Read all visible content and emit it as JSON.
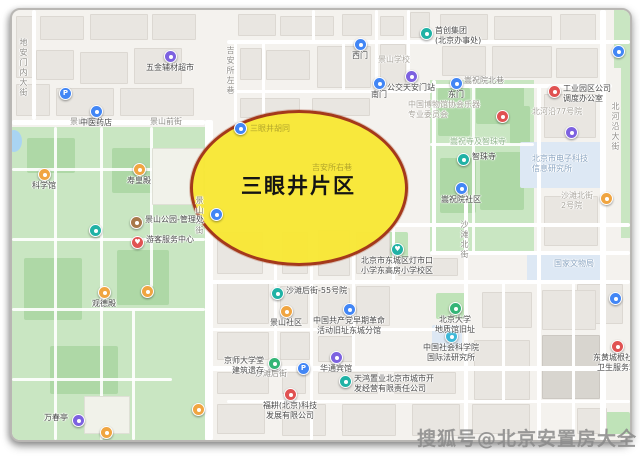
{
  "highlight": {
    "label": "三眼井片区",
    "fill": "#f8e734",
    "border": "#a4391b"
  },
  "watermark": {
    "text": "搜狐号@北京安置房大全"
  },
  "map": {
    "poi_colors": {
      "blue": "#4286f5",
      "purple": "#7d62e0",
      "teal": "#20b2a5",
      "red": "#e05252",
      "orange": "#f0a541",
      "brown": "#a8784a",
      "green": "#35b576",
      "cyan": "#3cb8d8"
    },
    "in_ellipse_labels": [
      {
        "text": "三眼井胡同",
        "x": 238,
        "y": 113
      },
      {
        "text": "吉安所右巷",
        "x": 300,
        "y": 152
      }
    ],
    "labels": [
      {
        "lines": [
          "地安门内大街"
        ],
        "x": 6,
        "y": 28,
        "style": "roadv"
      },
      {
        "lines": [
          "景山后街"
        ],
        "x": 58,
        "y": 107,
        "style": "road"
      },
      {
        "lines": [
          "景山前街"
        ],
        "x": 138,
        "y": 107,
        "style": "road"
      },
      {
        "lines": [
          "景山东街"
        ],
        "x": 182,
        "y": 186,
        "style": "roadv"
      },
      {
        "lines": [
          "吉安所左巷"
        ],
        "x": 213,
        "y": 36,
        "style": "roadv"
      },
      {
        "lines": [
          "嵩祝院北巷"
        ],
        "x": 452,
        "y": 66,
        "style": "road"
      },
      {
        "lines": [
          "沙滩北街"
        ],
        "x": 447,
        "y": 210,
        "style": "roadv"
      },
      {
        "lines": [
          "沙滩后街"
        ],
        "x": 243,
        "y": 359,
        "style": "road"
      },
      {
        "lines": [
          "北河沿大街"
        ],
        "x": 598,
        "y": 92,
        "style": "roadv"
      },
      {
        "lines": [
          "景山学校"
        ],
        "x": 366,
        "y": 45,
        "style": "area"
      },
      {
        "lines": [
          "北河沿77号院"
        ],
        "x": 520,
        "y": 97,
        "style": "area"
      },
      {
        "lines": [
          "北京市电子科技",
          "信息研究所"
        ],
        "x": 520,
        "y": 144,
        "style": "blue"
      },
      {
        "lines": [
          "国家文物局"
        ],
        "x": 542,
        "y": 249,
        "style": "blue"
      },
      {
        "lines": [
          "沙滩北街",
          "2号院"
        ],
        "x": 549,
        "y": 181,
        "style": "area"
      },
      {
        "lines": [
          "中国博物馆协会乐器",
          "专业委员会"
        ],
        "x": 396,
        "y": 90,
        "style": "area"
      },
      {
        "lines": [
          "嵩祝寺及智珠寺"
        ],
        "x": 438,
        "y": 127,
        "style": "faintgreen"
      }
    ],
    "pois": [
      {
        "x": 152,
        "y": 40,
        "c": "purple",
        "label": [
          "五金辅材超市"
        ],
        "pos": "below"
      },
      {
        "x": 47,
        "y": 77,
        "c": "blue",
        "g": "P"
      },
      {
        "x": 78,
        "y": 95,
        "c": "blue",
        "label": [
          "中医药店"
        ],
        "pos": "below"
      },
      {
        "x": 342,
        "y": 28,
        "c": "blue",
        "label": [
          "西门"
        ],
        "pos": "below"
      },
      {
        "x": 408,
        "y": 17,
        "c": "teal",
        "label": [
          "首创集团",
          "(北京办事处)"
        ],
        "pos": "right"
      },
      {
        "x": 393,
        "y": 60,
        "c": "purple",
        "label": [
          "公交天安门站"
        ],
        "pos": "below"
      },
      {
        "x": 361,
        "y": 67,
        "c": "blue",
        "label": [
          "南门"
        ],
        "pos": "below"
      },
      {
        "x": 438,
        "y": 67,
        "c": "blue",
        "label": [
          "东门"
        ],
        "pos": "below"
      },
      {
        "x": 536,
        "y": 75,
        "c": "red",
        "label": [
          "工业园区公司",
          "调度办公室"
        ],
        "pos": "right"
      },
      {
        "x": 600,
        "y": 35,
        "c": "blue"
      },
      {
        "x": 445,
        "y": 143,
        "c": "teal",
        "label": [
          "智珠寺"
        ],
        "pos": "right"
      },
      {
        "x": 484,
        "y": 100,
        "c": "red"
      },
      {
        "x": 443,
        "y": 172,
        "c": "blue",
        "label": [
          "嵩祝院社区"
        ],
        "pos": "below"
      },
      {
        "x": 553,
        "y": 116,
        "c": "purple"
      },
      {
        "x": 588,
        "y": 182,
        "c": "orange"
      },
      {
        "x": 259,
        "y": 277,
        "c": "teal",
        "label": [
          "沙滩后街-55号院"
        ],
        "pos": "right"
      },
      {
        "x": 268,
        "y": 295,
        "c": "orange",
        "label": [
          "景山社区"
        ],
        "pos": "below"
      },
      {
        "x": 331,
        "y": 293,
        "c": "blue",
        "label": [
          "中国共产党早期革命",
          "活动旧址东城分馆"
        ],
        "pos": "below"
      },
      {
        "x": 256,
        "y": 347,
        "c": "green",
        "label": [
          "京师大学堂",
          "建筑遗存"
        ],
        "pos": "left"
      },
      {
        "x": 285,
        "y": 352,
        "c": "blue",
        "g": "P"
      },
      {
        "x": 318,
        "y": 341,
        "c": "purple",
        "label": [
          "华通宾馆"
        ],
        "pos": "below"
      },
      {
        "x": 379,
        "y": 233,
        "c": "teal",
        "g": "♥",
        "label": [
          "北京市东城区灯市口",
          "小学东高房小学校区"
        ],
        "pos": "below"
      },
      {
        "x": 437,
        "y": 292,
        "c": "green",
        "label": [
          "北京大学",
          "地质馆旧址"
        ],
        "pos": "below"
      },
      {
        "x": 433,
        "y": 320,
        "c": "cyan",
        "label": [
          "中国社会科学院",
          "国际法研究所"
        ],
        "pos": "below"
      },
      {
        "x": 599,
        "y": 330,
        "c": "red",
        "label": [
          "东黄城根社区",
          "卫生服务站"
        ],
        "pos": "below"
      },
      {
        "x": 597,
        "y": 282,
        "c": "blue"
      },
      {
        "x": 327,
        "y": 365,
        "c": "teal",
        "label": [
          "天鸿置业北京市城市开",
          "发经营有限责任公司"
        ],
        "pos": "right"
      },
      {
        "x": 272,
        "y": 378,
        "c": "red",
        "label": [
          "福耕(北京)科技",
          "发展有限公司"
        ],
        "pos": "below"
      },
      {
        "x": 26,
        "y": 158,
        "c": "orange",
        "label": [
          "科学馆"
        ],
        "pos": "below"
      },
      {
        "x": 121,
        "y": 153,
        "c": "orange",
        "label": [
          "寿皇殿"
        ],
        "pos": "below"
      },
      {
        "x": 118,
        "y": 206,
        "c": "brown",
        "label": [
          "景山公园-管理处"
        ],
        "pos": "right"
      },
      {
        "x": 119,
        "y": 226,
        "c": "red",
        "g": "♥",
        "label": [
          "游客服务中心"
        ],
        "pos": "right"
      },
      {
        "x": 77,
        "y": 214,
        "c": "teal"
      },
      {
        "x": 86,
        "y": 276,
        "c": "orange",
        "label": [
          "观德殿"
        ],
        "pos": "below"
      },
      {
        "x": 129,
        "y": 275,
        "c": "orange"
      },
      {
        "x": 60,
        "y": 404,
        "c": "purple",
        "label": [
          "万春亭"
        ],
        "pos": "left"
      },
      {
        "x": 88,
        "y": 416,
        "c": "orange"
      },
      {
        "x": 180,
        "y": 393,
        "c": "orange"
      },
      {
        "x": 222,
        "y": 112,
        "c": "blue"
      },
      {
        "x": 198,
        "y": 198,
        "c": "blue"
      }
    ]
  }
}
